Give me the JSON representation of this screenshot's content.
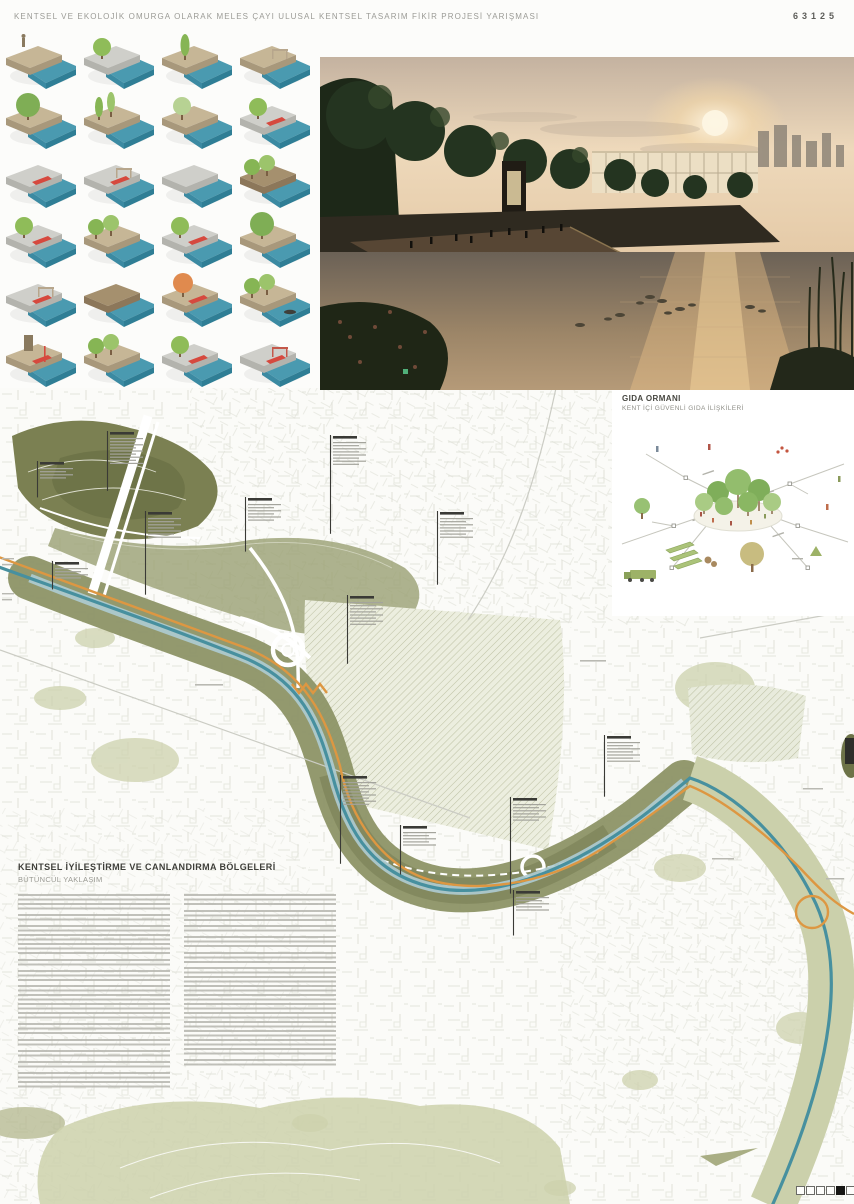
{
  "header": {
    "title": "KENTSEL VE EKOLOJİK OMURGA OLARAK MELES ÇAYI ULUSAL KENTSEL TASARIM FİKİR PROJESİ YARIŞMASI",
    "sheet_number": "63125"
  },
  "gida": {
    "title": "GIDA ORMANI",
    "subtitle": "KENT İÇİ GÜVENLİ GIDA İLİŞKİLERİ"
  },
  "text_block": {
    "title": "KENTSEL İYİLEŞTİRME VE CANLANDIRMA BÖLGELERİ",
    "subtitle": "BÜTÜNCÜL YAKLAŞIM",
    "columns": [
      {
        "paragraph_line_counts": [
          4,
          2,
          7,
          2,
          3,
          8,
          3,
          2,
          2,
          2,
          4
        ]
      },
      {
        "paragraph_line_counts": [
          3,
          3,
          2,
          3,
          3,
          20,
          2
        ]
      }
    ]
  },
  "legend_tiles": [
    {
      "land": "tan",
      "tree": "none",
      "red": false,
      "extra": "figure"
    },
    {
      "land": "gray",
      "tree": "round",
      "red": false,
      "extra": "none"
    },
    {
      "land": "tan",
      "tree": "tall",
      "red": false,
      "extra": "none"
    },
    {
      "land": "tan",
      "tree": "none",
      "red": false,
      "extra": "frame"
    },
    {
      "land": "tan",
      "tree": "big",
      "red": false,
      "extra": "none"
    },
    {
      "land": "tan",
      "tree": "tall2",
      "red": false,
      "extra": "none"
    },
    {
      "land": "tan",
      "tree": "pale",
      "red": false,
      "extra": "none"
    },
    {
      "land": "gray",
      "tree": "round",
      "red": true,
      "extra": "none"
    },
    {
      "land": "gray",
      "tree": "none",
      "red": true,
      "extra": "none"
    },
    {
      "land": "gray",
      "tree": "none",
      "red": true,
      "extra": "frame"
    },
    {
      "land": "gray",
      "tree": "none",
      "red": false,
      "extra": "none"
    },
    {
      "land": "brown",
      "tree": "round2",
      "red": false,
      "extra": "none"
    },
    {
      "land": "gray",
      "tree": "round",
      "red": true,
      "extra": "none"
    },
    {
      "land": "tan",
      "tree": "round2",
      "red": false,
      "extra": "none"
    },
    {
      "land": "gray",
      "tree": "round",
      "red": true,
      "extra": "none"
    },
    {
      "land": "tan",
      "tree": "big",
      "red": false,
      "extra": "none"
    },
    {
      "land": "gray",
      "tree": "none",
      "red": true,
      "extra": "frame"
    },
    {
      "land": "brown",
      "tree": "none",
      "red": false,
      "extra": "none"
    },
    {
      "land": "tan",
      "tree": "orange",
      "red": true,
      "extra": "none"
    },
    {
      "land": "tan",
      "tree": "round2",
      "red": false,
      "extra": "boat"
    },
    {
      "land": "tan",
      "tree": "none",
      "red": true,
      "extra": "tower"
    },
    {
      "land": "tan",
      "tree": "round2",
      "red": false,
      "extra": "none"
    },
    {
      "land": "gray",
      "tree": "round",
      "red": true,
      "extra": "none"
    },
    {
      "land": "gray",
      "tree": "none",
      "red": true,
      "extra": "redframe"
    }
  ],
  "map": {
    "annotations": [
      {
        "x": 110,
        "y": 44,
        "lines": 9,
        "leader": 26
      },
      {
        "x": 40,
        "y": 74,
        "lines": 4,
        "leader": 18
      },
      {
        "x": 333,
        "y": 48,
        "lines": 8,
        "leader": 68
      },
      {
        "x": 248,
        "y": 110,
        "lines": 6,
        "leader": 30
      },
      {
        "x": 440,
        "y": 124,
        "lines": 7,
        "leader": 46
      },
      {
        "x": 148,
        "y": 124,
        "lines": 7,
        "leader": 56
      },
      {
        "x": 55,
        "y": 174,
        "lines": 4,
        "leader": 10
      },
      {
        "x": 350,
        "y": 208,
        "lines": 8,
        "leader": 38
      },
      {
        "x": 607,
        "y": 348,
        "lines": 7,
        "leader": 34
      },
      {
        "x": 343,
        "y": 388,
        "lines": 8,
        "leader": 58
      },
      {
        "x": 403,
        "y": 438,
        "lines": 5,
        "leader": 28
      },
      {
        "x": 513,
        "y": 410,
        "lines": 6,
        "leader": 72
      },
      {
        "x": 516,
        "y": 503,
        "lines": 5,
        "leader": 24
      }
    ],
    "colors": {
      "river_teal": "#47909f",
      "river_light": "#aeccd3",
      "corridor_olive": "#8d9366",
      "hill_dark_olive": "#7b8052",
      "hill_pale": "#ccd1ab",
      "path_orange": "#dd9742",
      "accent_red": "#d6493e",
      "tile_water": "#4a9ab0"
    }
  },
  "indicator": {
    "cells": 6,
    "active_index": 4
  }
}
